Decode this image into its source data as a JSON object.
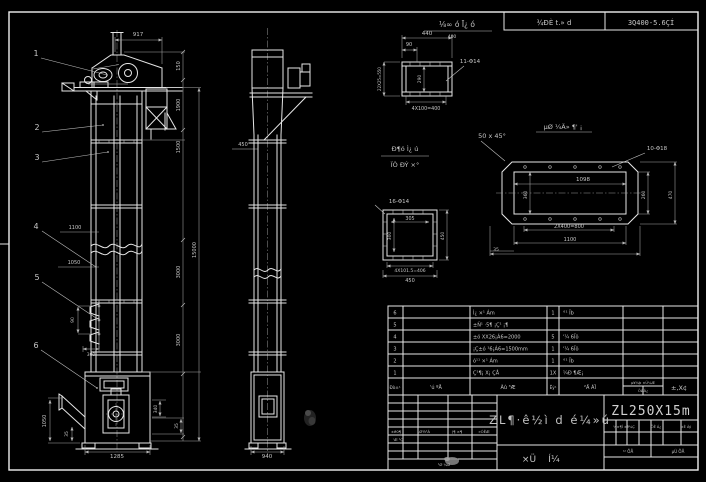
{
  "colors": {
    "background": "#000000",
    "line": "#e6e6e6",
    "text": "#c6c6c6"
  },
  "drawing": {
    "model": "ZL250X15m",
    "title": "ZL¶·ê½ì d é¼»ú",
    "subtitle_chars": [
      "×Ü",
      "Í¼"
    ],
    "top_strip": {
      "label": "⅛∞ ó Ī¿ ó",
      "label_sub": "400",
      "cell1": "¾ÐÈ t.» d",
      "cell2": "3Q400-5.6ÇÍ"
    }
  },
  "balloons": [
    {
      "t": "1",
      "x": 36,
      "y": 56,
      "s": 8
    },
    {
      "t": "2",
      "x": 37,
      "y": 130,
      "s": 8
    },
    {
      "t": "3",
      "x": 37,
      "y": 160,
      "s": 8
    },
    {
      "t": "4",
      "x": 36,
      "y": 229,
      "s": 8
    },
    {
      "t": "5",
      "x": 37,
      "y": 280,
      "s": 8
    },
    {
      "t": "6",
      "x": 36,
      "y": 348,
      "s": 8
    }
  ],
  "front_view": {
    "dims": [
      {
        "t": "917",
        "x": 138,
        "y": 36,
        "s": 5.5
      },
      {
        "t": "150",
        "x": 180,
        "y": 66,
        "r": -90,
        "s": 5
      },
      {
        "t": "1900",
        "x": 180,
        "y": 105,
        "r": -90,
        "s": 5
      },
      {
        "t": "1500",
        "x": 180,
        "y": 147,
        "r": -90,
        "s": 5
      },
      {
        "t": "3000",
        "x": 180,
        "y": 272,
        "r": -90,
        "s": 5
      },
      {
        "t": "3000",
        "x": 180,
        "y": 340,
        "r": -90,
        "s": 5
      },
      {
        "t": "15000",
        "x": 196,
        "y": 250,
        "r": -90,
        "s": 5
      },
      {
        "t": "1100",
        "x": 75,
        "y": 229,
        "s": 5
      },
      {
        "t": "1050",
        "x": 74,
        "y": 264,
        "s": 5
      },
      {
        "t": "90",
        "x": 74,
        "y": 320,
        "r": -90,
        "s": 4.5
      },
      {
        "t": "300",
        "x": 91,
        "y": 356,
        "s": 4.5
      },
      {
        "t": "1050",
        "x": 46,
        "y": 421,
        "r": -90,
        "s": 5
      },
      {
        "t": "35",
        "x": 68,
        "y": 434,
        "r": -90,
        "s": 4.5
      },
      {
        "t": "1285",
        "x": 117,
        "y": 458,
        "s": 5.5
      },
      {
        "t": "340",
        "x": 157,
        "y": 409,
        "r": -90,
        "s": 4.5
      },
      {
        "t": "35",
        "x": 178,
        "y": 426,
        "r": -90,
        "s": 4.5
      }
    ]
  },
  "side_view": {
    "dims": [
      {
        "t": "450",
        "x": 243,
        "y": 146,
        "s": 5
      },
      {
        "t": "940",
        "x": 267,
        "y": 458,
        "s": 5.5
      }
    ]
  },
  "details": {
    "labels": [
      {
        "t": "Ð¶ó Ì¿ ú",
        "x": 405,
        "y": 151,
        "s": 6.5
      },
      {
        "t": "ÏÒ ÐÝ ×°",
        "x": 405,
        "y": 167,
        "s": 6.5
      },
      {
        "t": "µØ ¼Ä» ¶' ¡",
        "x": 563,
        "y": 129,
        "s": 6.5
      }
    ],
    "dims": [
      {
        "t": "440",
        "x": 427,
        "y": 35,
        "s": 5.5
      },
      {
        "t": "90",
        "x": 409,
        "y": 46,
        "s": 5
      },
      {
        "t": "290",
        "x": 421,
        "y": 79,
        "r": -90,
        "s": 4.5
      },
      {
        "t": "22X25=550",
        "x": 381,
        "y": 79,
        "r": -90,
        "s": 4
      },
      {
        "t": "4X100=400",
        "x": 426,
        "y": 110,
        "s": 4.8
      },
      {
        "t": "11-Φ14",
        "x": 470,
        "y": 63,
        "s": 5.5
      },
      {
        "t": "50 x 45°",
        "x": 492,
        "y": 138,
        "s": 6.5
      },
      {
        "t": "16-Φ14",
        "x": 399,
        "y": 203,
        "s": 5.5
      },
      {
        "t": "305",
        "x": 410,
        "y": 220,
        "s": 4.8
      },
      {
        "t": "300",
        "x": 391,
        "y": 236,
        "r": -90,
        "s": 4.5
      },
      {
        "t": "450",
        "x": 444,
        "y": 236,
        "r": -90,
        "s": 4.5
      },
      {
        "t": "4X101.5=406",
        "x": 410,
        "y": 272,
        "s": 4.5
      },
      {
        "t": "450",
        "x": 410,
        "y": 282,
        "s": 5
      },
      {
        "t": "10-Φ18",
        "x": 657,
        "y": 150,
        "s": 5.5
      },
      {
        "t": "1098",
        "x": 583,
        "y": 181,
        "s": 5.5
      },
      {
        "t": "360",
        "x": 527,
        "y": 195,
        "r": -90,
        "s": 4.5
      },
      {
        "t": "260",
        "x": 645,
        "y": 195,
        "r": -90,
        "s": 4.5
      },
      {
        "t": "470",
        "x": 672,
        "y": 195,
        "r": -90,
        "s": 4.5
      },
      {
        "t": "2X400=800",
        "x": 569,
        "y": 228,
        "s": 5
      },
      {
        "t": "1100",
        "x": 570,
        "y": 241,
        "s": 5
      },
      {
        "t": "35",
        "x": 496,
        "y": 251,
        "s": 4.5
      }
    ]
  },
  "bom": {
    "rows": [
      {
        "no": "6",
        "desc": "Ì¿ ×¹ Ám",
        "qty": "1",
        "mat": "°¹ Ïb"
      },
      {
        "no": "5",
        "desc": "±Ñ¹ ·5¶ ¡Ç¹ ¡¶",
        "qty": "",
        "mat": ""
      },
      {
        "no": "4",
        "desc": "±ó XX26¡Á6=2000",
        "qty": "5",
        "mat": "'¼ 6Ïõ"
      },
      {
        "no": "3",
        "desc": "¡Ç±ó ¹6¡Á6=1500mm",
        "qty": "1",
        "mat": "'¼ 6Ïõ"
      },
      {
        "no": "2",
        "desc": "ó¹¹ ×¹ Ám",
        "qty": "1",
        "mat": "°¹ Ïb"
      },
      {
        "no": "1",
        "desc": "Ç¹¶¡ X¡ ÇÅ",
        "qty": "1X",
        "mat": "¼Ð ¶Æ¡"
      }
    ],
    "header": [
      {
        "t": "Ðò±¹",
        "x": 395,
        "y": 389,
        "s": 4.2
      },
      {
        "t": "'ú  ºÅ",
        "x": 436,
        "y": 389,
        "s": 5
      },
      {
        "t": "Ãû  ³Æ",
        "x": 508,
        "y": 389,
        "s": 5
      },
      {
        "t": "Êý¹",
        "x": 553,
        "y": 389,
        "s": 4.2
      },
      {
        "t": "²Ä  ÁÏ",
        "x": 590,
        "y": 389,
        "s": 5
      },
      {
        "t": "µ¥¼þ ×Ü¼Æ",
        "x": 643,
        "y": 384,
        "s": 3.6
      },
      {
        "t": "ÖØÁ¿",
        "x": 643,
        "y": 392,
        "s": 3.6
      },
      {
        "t": "±,X¢",
        "x": 679,
        "y": 390,
        "s": 6.5
      }
    ]
  },
  "title_block": {
    "small_labels": [
      {
        "t": "±ê0¶",
        "x": 396,
        "y": 433,
        "s": 3.8
      },
      {
        "t": ",Ø½¹Á",
        "x": 424,
        "y": 433,
        "s": 3.8
      },
      {
        "t": "(¶ ×¶",
        "x": 457,
        "y": 433,
        "s": 3.8
      },
      {
        "t": "»ÓÊÆ",
        "x": 484,
        "y": 433,
        "s": 3.8
      },
      {
        "t": "'Æ ¹Ç",
        "x": 398,
        "y": 441,
        "s": 3.8
      },
      {
        "t": "¹Ø ¼Ø",
        "x": 444,
        "y": 466,
        "s": 3.8
      },
      {
        "t": "¼×¶Î ±ê¼Ç",
        "x": 624,
        "y": 428,
        "s": 3.5
      },
      {
        "t": "ÖÊ Á¿",
        "x": 656,
        "y": 428,
        "s": 3.5
      },
      {
        "t": "±È Àý",
        "x": 686,
        "y": 428,
        "s": 3.5
      },
      {
        "t": "¹² ÕÅ",
        "x": 628,
        "y": 453,
        "s": 4
      },
      {
        "t": "µÚ ÕÅ",
        "x": 678,
        "y": 453,
        "s": 4
      }
    ]
  }
}
